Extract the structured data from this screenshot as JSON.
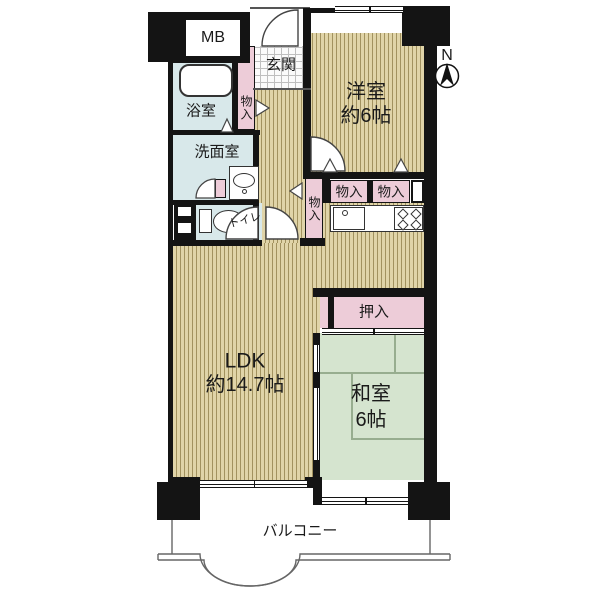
{
  "plan_title": "2LDK apartment floor plan",
  "compass": {
    "north_label": "N"
  },
  "rooms": {
    "meter_box": {
      "label": "MB"
    },
    "entrance": {
      "label": "玄関"
    },
    "western_room": {
      "label": "洋室",
      "size": "約6帖"
    },
    "bathroom": {
      "label": "浴室"
    },
    "washroom": {
      "label": "洗面室"
    },
    "toilet": {
      "label": "トイレ"
    },
    "ldk": {
      "label": "LDK",
      "size": "約14.7帖"
    },
    "japanese_room": {
      "label": "和室",
      "size": "6帖"
    },
    "closet_futon": {
      "label": "押入"
    },
    "balcony": {
      "label": "バルコニー"
    },
    "storage": {
      "label": "物入"
    }
  },
  "colors": {
    "wall": "#141414",
    "wood_floor": "#e0d4a8",
    "wood_stripe": "#a2925f",
    "tatami_green": "#d5e4cf",
    "wet_area_blue": "#d8e8ea",
    "closet_pink": "#edccd8"
  }
}
